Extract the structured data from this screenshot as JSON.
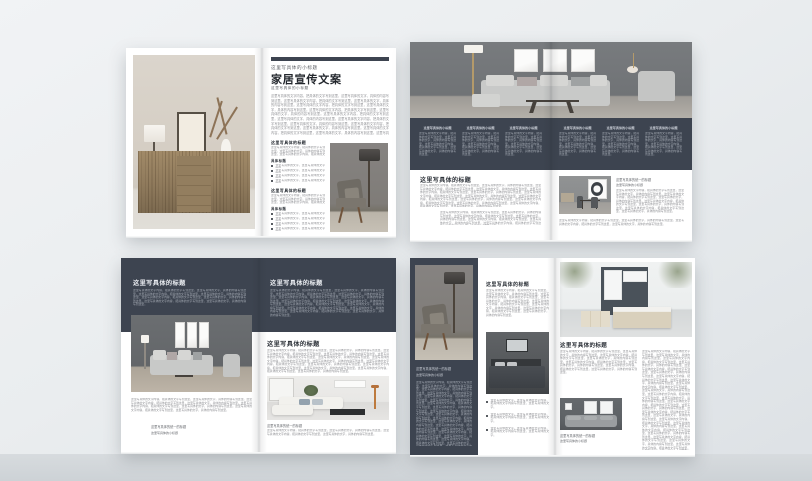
{
  "theme": {
    "accent_dark": "#3d4450",
    "canvas_bg": "#eaedef",
    "page_bg": "#ffffff",
    "body_text": "#8f9094",
    "band_text": "#a4aab3",
    "heading_text": "#2e333a"
  },
  "strings": {
    "main_title": "家居宣传文案",
    "eyebrow": "这里写具体的小标题",
    "section_title": "这里写具体的标题",
    "sub_title": "具体标题",
    "caption_primary": "这里写具体的统一的标题",
    "caption_secondary": "这里写具体的小标题",
    "bullet": "这里写具体的文字，这里写具体的文字内容。",
    "bullet_long": "这里写具体的文字，这里写具体的文字内容，把具体的文字内容写到这里，这里写具体的文字。",
    "body_s": "这里写具体的文字内容，把具体的文字写到这里，这里写具体的文字，具体的内容写到这里。这里写具体的文字内容，把具体的文字写到这里，这里写具体的文字，具体的内容写到这里。",
    "body_m": "这里写具体的文字内容，把具体的文字写到这里，这里写具体的文字，具体的内容写到这里。这里写具体的文字内容，把具体的文字写到这里，这里写具体的文字，具体的内容写到这里。这里写具体的文字内容，把具体的文字写到这里，这里写具体的文字，具体的内容写到这里。这里写具体的文字内容，把具体的文字写到这里，这里写具体的文字，具体的内容写到这里。",
    "body_l": "这里写具体的文字内容，把具体的文字写到这里，这里写具体的文字，具体的内容写到这里。这里写具体的文字内容，把具体的文字写到这里，这里写具体的文字，具体的内容写到这里。这里写具体的文字内容，把具体的文字写到这里，这里写具体的文字，具体的内容写到这里。这里写具体的文字内容，把具体的文字写到这里，这里写具体的文字，具体的内容写到这里。这里写具体的文字内容，把具体的文字写到这里，这里写具体的文字，具体的内容写到这里。这里写具体的文字内容，把具体的文字写到这里，这里写具体的文字，具体的内容写到这里。这里写具体的文字内容，把具体的文字写到这里，这里写具体的文字，具体的内容写到这里。",
    "body_xl": "这里写具体的文字内容，把具体的文字写到这里，这里写具体的文字，具体的内容写到这里。这里写具体的文字内容，把具体的文字写到这里，这里写具体的文字，具体的内容写到这里。这里写具体的文字内容，把具体的文字写到这里，这里写具体的文字，具体的内容写到这里。这里写具体的文字内容，把具体的文字写到这里，这里写具体的文字，具体的内容写到这里。这里写具体的文字内容，把具体的文字写到这里，这里写具体的文字，具体的内容写到这里。这里写具体的文字内容，把具体的文字写到这里，这里写具体的文字，具体的内容写到这里。这里写具体的文字内容，把具体的文字写到这里，这里写具体的文字，具体的内容写到这里。这里写具体的文字内容，把具体的文字写到这里，这里写具体的文字，具体的内容写到这里。这里写具体的文字内容，把具体的文字写到这里，这里写具体的文字，具体的内容写到这里。这里写具体的文字内容，把具体的文字写到这里，这里写具体的文字，具体的内容写到这里。",
    "body_xxl": "这里写具体的文字内容，把具体的文字写到这里，这里写具体的文字，具体的内容写到这里。这里写具体的文字内容，把具体的文字写到这里，这里写具体的文字，具体的内容写到这里。这里写具体的文字内容，把具体的文字写到这里，这里写具体的文字，具体的内容写到这里。这里写具体的文字内容，把具体的文字写到这里，这里写具体的文字，具体的内容写到这里。这里写具体的文字内容，把具体的文字写到这里，这里写具体的文字，具体的内容写到这里。这里写具体的文字内容，把具体的文字写到这里，这里写具体的文字，具体的内容写到这里。这里写具体的文字内容，把具体的文字写到这里，这里写具体的文字，具体的内容写到这里。这里写具体的文字内容，把具体的文字写到这里，这里写具体的文字，具体的内容写到这里。这里写具体的文字内容，把具体的文字写到这里，这里写具体的文字，具体的内容写到这里。这里写具体的文字内容，把具体的文字写到这里，这里写具体的文字，具体的内容写到这里。这里写具体的文字内容，把具体的文字写到这里，这里写具体的文字，具体的内容写到这里。这里写具体的文字内容，把具体的文字写到这里，这里写具体的文字，具体的内容写到这里。这里写具体的文字内容，把具体的文字写到这里，这里写具体的文字，具体的内容写到这里。这里写具体的文字内容，把具体的文字写到这里，这里写具体的文字，具体的内容写到这里。"
  }
}
